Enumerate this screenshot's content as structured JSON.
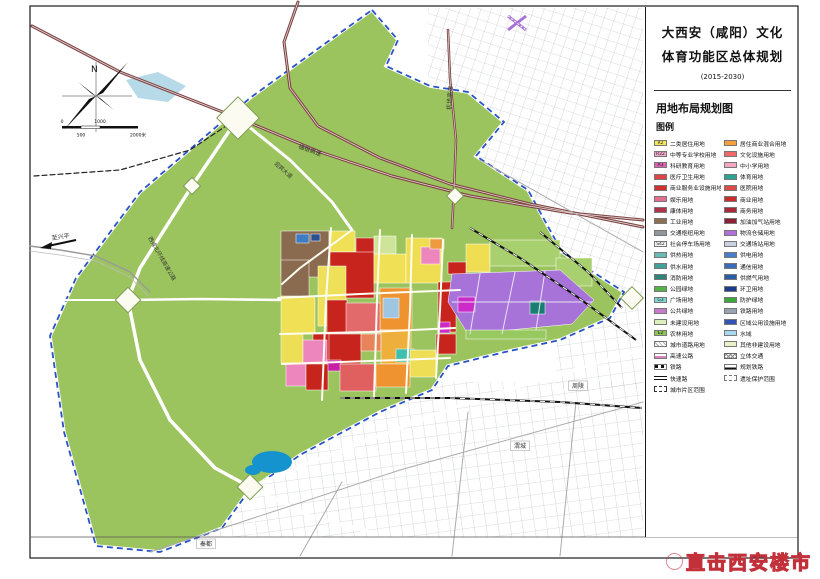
{
  "panel": {
    "title_line1": "大西安（咸阳）文化",
    "title_line2": "体育功能区总体规划",
    "period": "(2015-2030)",
    "map_name": "用地布局规划图",
    "legend_title": "图例"
  },
  "compass": {
    "label": "N"
  },
  "scale_bar": {
    "t0": "0",
    "t1": "500",
    "t2": "1000",
    "t3": "2000米"
  },
  "watermark": {
    "text": "直击西安楼市"
  },
  "legend": {
    "left": [
      {
        "code": "R2",
        "color": "#F2E75C",
        "label": "二类居住用地"
      },
      {
        "code": "R22",
        "color": "#F2A6CA",
        "label": "中等专业学校用地"
      },
      {
        "code": "A3",
        "color": "#DE5FB4",
        "label": "科研教育用地"
      },
      {
        "color": "#E04545",
        "label": "医疗卫生用地"
      },
      {
        "color": "#D23030",
        "label": "商业服务业设施用地"
      },
      {
        "color": "#E56E8C",
        "label": "娱乐用地"
      },
      {
        "color": "#B03348",
        "label": "康体用地"
      },
      {
        "color": "#8C6E50",
        "label": "工业用地"
      },
      {
        "color": "#909699",
        "label": "交通枢纽用地"
      },
      {
        "code": "S42",
        "color": "#F5F5F2",
        "label": "社会停车场用地"
      },
      {
        "color": "#66BCB4",
        "label": "供热用地"
      },
      {
        "color": "#41A098",
        "label": "供水用地"
      },
      {
        "color": "#2E837C",
        "label": "消防用地"
      },
      {
        "color": "#53B549",
        "label": "公园绿地"
      },
      {
        "code": "G3",
        "color": "#82DAD2",
        "label": "广场用地"
      },
      {
        "color": "#C77BCB",
        "label": "公共绿地"
      },
      {
        "color": "#DCEFBC",
        "label": "未建设用地"
      },
      {
        "code": "E2",
        "color": "#8CC455",
        "label": "农林用地"
      },
      {
        "type": "hatch",
        "label": "城市道路用地"
      },
      {
        "type": "hwy",
        "label": "高速公路"
      },
      {
        "type": "rail",
        "label": "铁路"
      },
      {
        "type": "expwy",
        "label": "快速路"
      },
      {
        "type": "zone",
        "label": "城市片区范围"
      }
    ],
    "right": [
      {
        "color": "#F5A23C",
        "label": "居住商业混合用地"
      },
      {
        "color": "#EE6A6A",
        "label": "文化设施用地"
      },
      {
        "color": "#F2A8C0",
        "label": "中小学用地"
      },
      {
        "color": "#2FA393",
        "label": "体育用地"
      },
      {
        "color": "#DC4A4A",
        "label": "医院用地"
      },
      {
        "color": "#CC2B2B",
        "label": "商业用地"
      },
      {
        "color": "#A82838",
        "label": "商务用地"
      },
      {
        "color": "#8B2030",
        "label": "加油加气站用地"
      },
      {
        "color": "#B070D8",
        "label": "物流仓储用地"
      },
      {
        "color": "#C9D2DE",
        "label": "交通场站用地"
      },
      {
        "color": "#4A7CC8",
        "label": "供电用地"
      },
      {
        "color": "#3A6CB8",
        "label": "通信用地"
      },
      {
        "color": "#2A5CA8",
        "label": "供燃气用地"
      },
      {
        "color": "#1F3C8C",
        "label": "环卫用地"
      },
      {
        "color": "#3CA83C",
        "label": "防护绿地"
      },
      {
        "color": "#98A2B0",
        "label": "铁路用地"
      },
      {
        "color": "#3353B5",
        "label": "区域公用设施用地"
      },
      {
        "color": "#A9D9F0",
        "label": "水域"
      },
      {
        "color": "#E9F2CB",
        "label": "其他非建设用地"
      },
      {
        "type": "xhatch",
        "label": "立体交通"
      },
      {
        "type": "railplan",
        "label": "规划铁路"
      },
      {
        "type": "heritage",
        "label": "遗址保护范围"
      }
    ]
  },
  "map": {
    "colors": {
      "green": "#9CC45E",
      "boundary": "#2A52C8",
      "highway": "#7E4444",
      "water": "#1593CE",
      "lake": "#AED6E6"
    },
    "green_pts": "372,10 398,40 386,66 430,86 468,92 504,122 476,156 528,190 562,252 624,292 610,318 560,340 505,352 448,366 432,390 380,412 300,455 248,492 222,528 160,552 96,546 64,432 50,336 76,278 140,192 250,98 330,40",
    "city_areas": [
      {
        "x": 428,
        "y": 8,
        "w": 215,
        "h": 292,
        "p": "ne"
      },
      {
        "x": 96,
        "y": 382,
        "w": 547,
        "h": 155,
        "p": "s"
      },
      {
        "x": 556,
        "y": 288,
        "w": 87,
        "h": 100,
        "p": "s"
      }
    ],
    "waters": [
      {
        "type": "ellipse",
        "cx": 272,
        "cy": 462,
        "rx": 20,
        "ry": 11,
        "c": "#1593CE"
      },
      {
        "type": "ellipse",
        "cx": 253,
        "cy": 470,
        "rx": 8,
        "ry": 5,
        "c": "#1593CE"
      },
      {
        "type": "poly",
        "pts": "126,80 158,72 186,86 168,102 138,98",
        "c": "#AED6E6"
      }
    ],
    "parcels": [
      {
        "x": 281,
        "y": 231,
        "w": 48,
        "h": 46,
        "c": "#8A6B4F"
      },
      {
        "x": 281,
        "y": 260,
        "w": 28,
        "h": 38,
        "c": "#8A6B4F"
      },
      {
        "x": 296,
        "y": 234,
        "w": 13,
        "h": 9,
        "c": "#3E7CC4"
      },
      {
        "x": 311,
        "y": 234,
        "w": 9,
        "h": 7,
        "c": "#2A5090"
      },
      {
        "x": 329,
        "y": 231,
        "w": 26,
        "h": 21,
        "c": "#F0E055"
      },
      {
        "x": 356,
        "y": 238,
        "w": 18,
        "h": 15,
        "c": "#C8241E"
      },
      {
        "x": 330,
        "y": 252,
        "w": 44,
        "h": 46,
        "c": "#C8241E"
      },
      {
        "x": 374,
        "y": 236,
        "w": 22,
        "h": 18,
        "c": "#CEE49A"
      },
      {
        "x": 374,
        "y": 254,
        "w": 32,
        "h": 29,
        "c": "#F0E055"
      },
      {
        "x": 406,
        "y": 238,
        "w": 36,
        "h": 45,
        "c": "#F0DE52"
      },
      {
        "x": 421,
        "y": 247,
        "w": 19,
        "h": 17,
        "c": "#EE86BE"
      },
      {
        "x": 430,
        "y": 239,
        "w": 14,
        "h": 10,
        "c": "#EE9A40"
      },
      {
        "x": 318,
        "y": 266,
        "w": 28,
        "h": 60,
        "c": "#EEE058"
      },
      {
        "x": 281,
        "y": 296,
        "w": 34,
        "h": 38,
        "c": "#F0E055"
      },
      {
        "x": 380,
        "y": 288,
        "w": 32,
        "h": 42,
        "c": "#EE9330"
      },
      {
        "x": 383,
        "y": 298,
        "w": 16,
        "h": 20,
        "c": "#9EC6E2"
      },
      {
        "x": 438,
        "y": 282,
        "w": 18,
        "h": 50,
        "c": "#C8241E"
      },
      {
        "x": 327,
        "y": 300,
        "w": 20,
        "h": 34,
        "c": "#C8241E"
      },
      {
        "x": 346,
        "y": 303,
        "w": 34,
        "h": 30,
        "c": "#E26A6A"
      },
      {
        "x": 327,
        "y": 334,
        "w": 34,
        "h": 30,
        "c": "#C8241E"
      },
      {
        "x": 361,
        "y": 334,
        "w": 20,
        "h": 17,
        "c": "#E8845C"
      },
      {
        "x": 381,
        "y": 330,
        "w": 30,
        "h": 34,
        "c": "#EFAF3C"
      },
      {
        "x": 396,
        "y": 349,
        "w": 18,
        "h": 13,
        "c": "#3FBFAE"
      },
      {
        "x": 281,
        "y": 334,
        "w": 22,
        "h": 29,
        "c": "#EEDE55"
      },
      {
        "x": 313,
        "y": 334,
        "w": 16,
        "h": 30,
        "c": "#C8241E"
      },
      {
        "x": 303,
        "y": 340,
        "w": 24,
        "h": 24,
        "c": "#EE86BE"
      },
      {
        "x": 327,
        "y": 360,
        "w": 14,
        "h": 11,
        "c": "#C620A6"
      },
      {
        "x": 286,
        "y": 364,
        "w": 20,
        "h": 22,
        "c": "#EE86BE"
      },
      {
        "x": 306,
        "y": 364,
        "w": 22,
        "h": 26,
        "c": "#C8241E"
      },
      {
        "x": 340,
        "y": 364,
        "w": 36,
        "h": 27,
        "c": "#E06060"
      },
      {
        "x": 376,
        "y": 364,
        "w": 34,
        "h": 23,
        "c": "#EE9330"
      },
      {
        "x": 410,
        "y": 350,
        "w": 26,
        "h": 27,
        "c": "#EEDE55"
      },
      {
        "x": 436,
        "y": 334,
        "w": 20,
        "h": 20,
        "c": "#C8241E"
      },
      {
        "x": 466,
        "y": 244,
        "w": 24,
        "h": 28,
        "c": "#F0DE52"
      },
      {
        "x": 448,
        "y": 262,
        "w": 18,
        "h": 12,
        "c": "#C8241E"
      },
      {
        "x": 490,
        "y": 240,
        "w": 70,
        "h": 26,
        "c": "#A8D06E"
      },
      {
        "x": 556,
        "y": 258,
        "w": 36,
        "h": 28,
        "c": "#A8D06E"
      },
      {
        "pts": "452,274 560,270 594,300 572,324 468,334 448,302",
        "c": "#A873D8"
      },
      {
        "x": 530,
        "y": 301,
        "w": 15,
        "h": 13,
        "c": "#177F72"
      },
      {
        "x": 458,
        "y": 297,
        "w": 17,
        "h": 15,
        "c": "#CC2BC8"
      },
      {
        "x": 438,
        "y": 322,
        "w": 12,
        "h": 11,
        "c": "#CC2BC8"
      },
      {
        "x": 466,
        "y": 330,
        "w": 80,
        "h": 9,
        "c": "#98C860"
      }
    ],
    "roads": [
      {
        "pts": "238,118 192,186 140,268 128,300 140,360 170,420 215,468 250,487 310,516 370,532",
        "c": "#FFFFFF",
        "w": 3.5
      },
      {
        "pts": "238,118 240,40 242,10",
        "c": "#FFFFFF",
        "w": 2.5
      },
      {
        "pts": "238,118 290,160 332,202 352,230",
        "c": "#FFFFFF",
        "w": 3
      },
      {
        "pts": "128,300 200,299 280,300",
        "c": "#FFFFFF",
        "w": 2.5
      },
      {
        "pts": "250,487 330,455 420,420 470,402 520,386 600,362 642,350",
        "c": "#FFFFFF",
        "w": 3.5
      },
      {
        "pts": "250,487 254,520 256,548",
        "c": "#FFFFFF",
        "w": 2.5
      },
      {
        "pts": "56,300 128,300",
        "c": "#FFFFFF",
        "w": 2
      },
      {
        "pts": "331,228 326,300 322,400",
        "c": "#FFFDF2",
        "w": 2
      },
      {
        "pts": "380,230 377,300 374,398",
        "c": "#FFFDF2",
        "w": 2
      },
      {
        "pts": "412,235 410,310 406,393",
        "c": "#FFFDF2",
        "w": 2
      },
      {
        "pts": "443,240 440,310 436,378",
        "c": "#FFFDF2",
        "w": 2
      },
      {
        "pts": "278,298 360,294 460,290",
        "c": "#FFFDF2",
        "w": 2
      },
      {
        "pts": "280,334 370,332 455,328",
        "c": "#FFFDF2",
        "w": 2
      },
      {
        "pts": "282,364 370,361 450,358",
        "c": "#FFFDF2",
        "w": 2
      },
      {
        "pts": "352,230 300,268 282,284",
        "c": "#FFFDF2",
        "w": 2
      },
      {
        "pts": "480,274 470,334",
        "c": "#E8E0F4",
        "w": 1
      },
      {
        "pts": "515,272 502,334",
        "c": "#E8E0F4",
        "w": 1
      },
      {
        "pts": "545,271 536,330",
        "c": "#E8E0F4",
        "w": 1
      },
      {
        "pts": "452,302 592,302",
        "c": "#E8E0F4",
        "w": 1
      },
      {
        "pts": "32,26 120,72 238,118 320,152 392,176 470,196 570,213 643,220",
        "c": "#7E4444",
        "w": 3
      },
      {
        "pts": "298,2 284,42 290,88 318,126 380,158 450,184 530,204 643,227",
        "c": "#7E4444",
        "w": 3
      },
      {
        "pts": "448,30 450,78 456,140 454,190 452,228",
        "c": "#7E4444",
        "w": 2.5
      },
      {
        "pts": "32,26 120,72 238,118 320,152 392,176 470,196 570,213 643,220",
        "c": "#E8D8D8",
        "w": 0.8
      },
      {
        "pts": "298,2 284,42 290,88 318,126 380,158 450,184 530,204 643,227",
        "c": "#E8D8D8",
        "w": 0.8
      },
      {
        "pts": "448,30 450,78 456,140 454,190 452,228",
        "c": "#E8D8D8",
        "w": 0.7
      },
      {
        "pts": "34,176 120,170 190,150 238,118",
        "c": "#222222",
        "w": 1.2,
        "dash": "5,3"
      },
      {
        "pts": "30,246 60,250 96,256 130,272 150,292",
        "c": "#999999",
        "w": 1.4
      },
      {
        "pts": "30,251 60,255 96,261 130,277 148,296",
        "c": "#BBBBBB",
        "w": 0.8
      },
      {
        "pts": "480,160 643,252",
        "c": "#AAAAAA",
        "w": 1
      },
      {
        "pts": "150,552 400,470 643,402",
        "c": "#AAAAAA",
        "w": 1
      },
      {
        "pts": "300,556 342,482",
        "c": "#AAAAAA",
        "w": 1
      },
      {
        "pts": "452,556 468,412",
        "c": "#AAAAAA",
        "w": 1
      },
      {
        "pts": "560,556 576,402",
        "c": "#AAAAAA",
        "w": 1
      },
      {
        "pts": "30,537 798,537",
        "c": "#555555",
        "w": 0.8
      }
    ],
    "rails": [
      {
        "pts": "470,228 520,258 576,296 636,340"
      },
      {
        "pts": "340,398 450,398 560,402 642,408"
      },
      {
        "pts": "540,232 588,272 622,308"
      }
    ],
    "diamonds": [
      {
        "x": 238,
        "y": 118,
        "r": 15
      },
      {
        "x": 128,
        "y": 300,
        "r": 9
      },
      {
        "x": 250,
        "y": 487,
        "r": 9
      },
      {
        "x": 192,
        "y": 186,
        "r": 6
      },
      {
        "x": 632,
        "y": 298,
        "r": 8
      },
      {
        "x": 455,
        "y": 196,
        "r": 6
      }
    ],
    "crossing_symbol": {
      "x": 517,
      "y": 23
    },
    "labels": [
      {
        "t": "机场高速",
        "x": 451,
        "y": 110,
        "r": -86,
        "s": 6
      },
      {
        "t": "福银高速",
        "x": 298,
        "y": 148,
        "r": 20,
        "s": 6
      },
      {
        "t": "迎宾大道",
        "x": 274,
        "y": 164,
        "r": 42,
        "s": 5.5
      },
      {
        "t": "西咸北环线高速公路",
        "x": 148,
        "y": 238,
        "r": 60,
        "s": 5.5
      },
      {
        "t": "至兴平",
        "x": 52,
        "y": 240,
        "r": -8,
        "s": 6
      },
      {
        "t": "周陵",
        "x": 578,
        "y": 388,
        "s": 6,
        "box": true
      },
      {
        "t": "渭城",
        "x": 520,
        "y": 448,
        "s": 6,
        "box": true
      },
      {
        "t": "秦都",
        "x": 206,
        "y": 546,
        "s": 6,
        "box": true
      }
    ]
  }
}
